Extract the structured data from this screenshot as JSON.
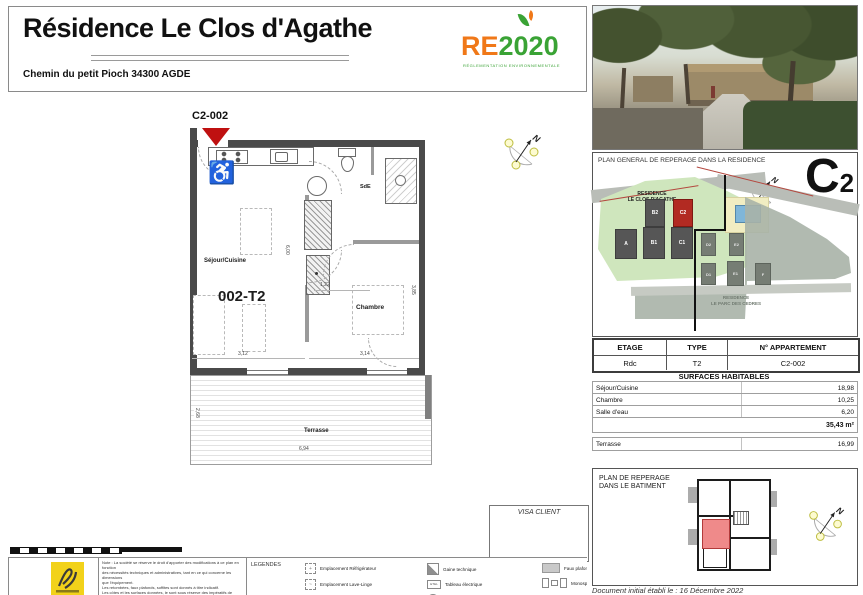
{
  "header": {
    "title": "Résidence Le Clos d'Agathe",
    "address": "Chemin du petit Pioch 34300 AGDE",
    "re2020": {
      "re": "RE",
      "year": "2020",
      "subtitle": "RÉGLEMENTATION ENVIRONNEMENTALE"
    }
  },
  "floor_plan": {
    "marker": "C2-002",
    "unit": "002-T2",
    "rooms": {
      "sejour": "Séjour/Cuisine",
      "chambre": "Chambre",
      "sde": "SdE",
      "terrasse": "Terrasse"
    },
    "dims": {
      "w_sejour": "3,12",
      "w_hall": "1,22",
      "w_chambre": "3,14",
      "h_sejour": "6,00",
      "h_chambre": "3,85",
      "w_terrasse": "6,94",
      "h_terrasse": "2,68"
    }
  },
  "compass": {
    "n": "N"
  },
  "residence_plan": {
    "title": "PLAN GENERAL DE REPERAGE DANS LA RESIDENCE",
    "letter": "C",
    "letter_sub": "2",
    "zone_a": {
      "line1": "RESIDENCE",
      "line2": "LE CLOS D'AGATHE"
    },
    "zone_b": {
      "line1": "RESIDENCE",
      "line2": "LE PARC DES CEDRES"
    },
    "buildings": {
      "a": "A",
      "b1": "B1",
      "c1": "C1",
      "b2": "B2",
      "c2": "C2",
      "d2": "D2",
      "e2": "E2",
      "d1": "D1",
      "e1": "E1",
      "f": "F"
    }
  },
  "info_table": {
    "headers": {
      "etage": "ETAGE",
      "type": "TYPE",
      "num": "N° APPARTEMENT"
    },
    "values": {
      "etage": "Rdc",
      "type": "T2",
      "num": "C2-002"
    }
  },
  "surfaces": {
    "title": "SURFACES HABITABLES",
    "rows": [
      {
        "label": "Séjour/Cuisine",
        "value": "18,98"
      },
      {
        "label": "Chambre",
        "value": "10,25"
      },
      {
        "label": "Salle d'eau",
        "value": "6,20"
      }
    ],
    "total": "35,43 m²",
    "terrasse": {
      "label": "Terrasse",
      "value": "16,99"
    }
  },
  "building_plan": {
    "title_line1": "PLAN DE REPERAGE",
    "title_line2": "DANS LE BATIMENT"
  },
  "visa": {
    "label": "VISA CLIENT"
  },
  "note": {
    "lines": [
      "Note : La société se réserve le droit d'apporter des modifications à ce plan en fonction",
      "des nécessités techniques et administratives, tant en ce qui concerne les dimensions",
      "que l'équipement.",
      "Les retombées, faux plafonds, soffites sont donnés à titre indicatif.",
      "Les côtes et les surfaces données, le sont sous réserve des impératifs de construction",
      "et de tolérance d'exécution."
    ]
  },
  "legend": {
    "title": "LEGENDES",
    "col1": [
      "Emplacement Réfrigérateur",
      "Emplacement Lave-Linge",
      "Emplacement Lave-Vaisselle"
    ],
    "col2": [
      "Gaine technique",
      "Tableau électrique",
      "Ballon d'eau chaude thermodynamique"
    ],
    "col3": [
      "Faux plafond",
      "Monosplit"
    ],
    "etel": "ETEL"
  },
  "footer": {
    "date": "Document initial établi le : 16 Décembre 2022"
  },
  "colors": {
    "marker_red": "#bf1010",
    "re_orange": "#f07818",
    "re_green": "#3aa335",
    "site_green": "#cfe6bd",
    "site_gray": "#a9b2a7",
    "pool_blue": "#7fb6d9",
    "room_red": "#ef8a8a"
  }
}
